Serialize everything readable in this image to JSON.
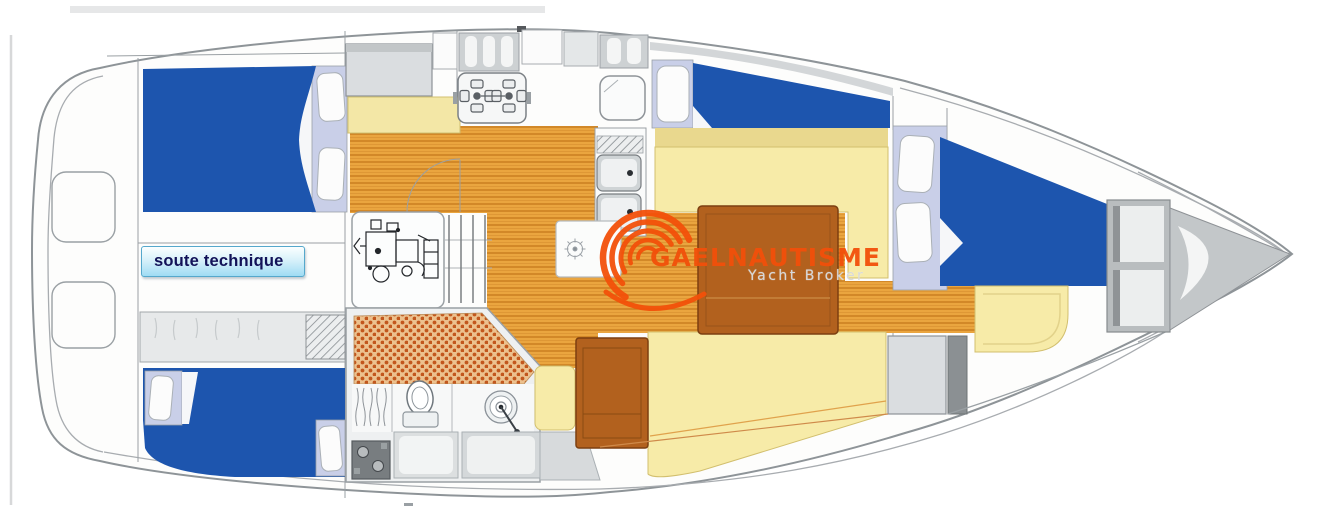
{
  "canvas": {
    "width": 1319,
    "height": 526,
    "background": "#ffffff"
  },
  "plan_label": {
    "text": "soute technique"
  },
  "watermark": {
    "brand": "GAELNAUTISME",
    "tagline": "Yacht Broker"
  },
  "palette": {
    "berth_blue": "#1d55ae",
    "cushion_yellow": "#f7eba8",
    "cushion_yellow_dark": "#e9d88e",
    "wood_base": "#eaa53f",
    "wood_stripe": "#c87c1e",
    "table_brown": "#b2611e",
    "table_border": "#7c3f10",
    "pillow_lavender": "#c9cfe8",
    "hull_line": "#8e9498",
    "furniture_grey": "#dadde0",
    "brand_orange": "#f2500a",
    "tagline_grey": "#d7d8d9",
    "label_border": "#55a8cc",
    "label_bg_top": "#fbffff",
    "label_bg_bottom": "#9fdcf4",
    "label_text": "#121258",
    "shower_dot": "#c2571d",
    "shower_bg": "#ecc18e"
  }
}
